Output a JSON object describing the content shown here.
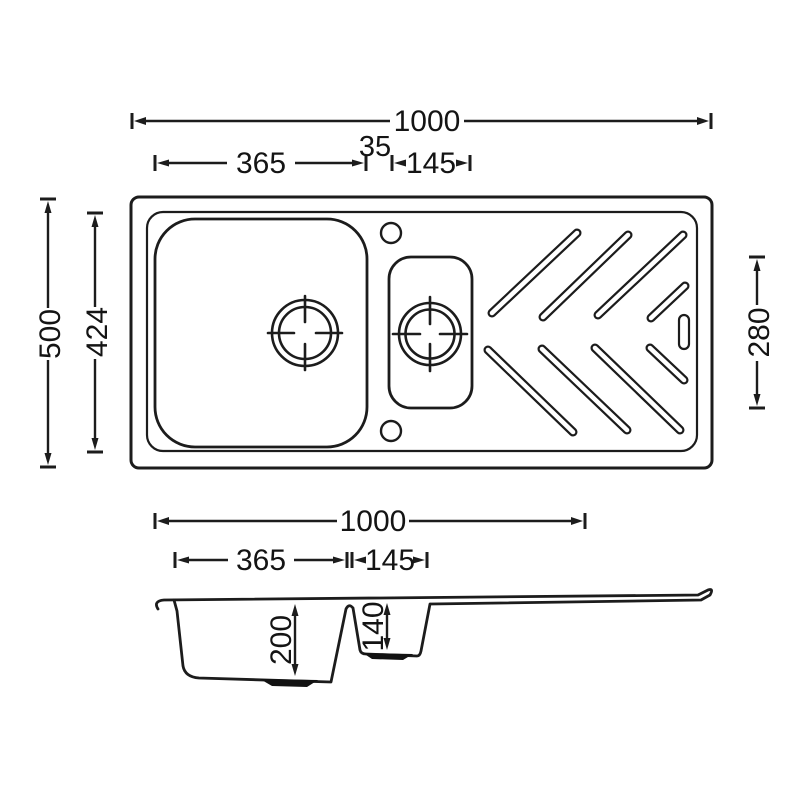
{
  "drawing_type": "kitchen-sink-dimension-diagram",
  "plan": {
    "overall_width_mm": "1000",
    "main_bowl_width_mm": "365",
    "between_bowls_mm": "35",
    "half_bowl_width_mm": "145",
    "overall_depth_mm": "500",
    "inner_frame_depth_mm": "424",
    "half_bowl_length_mm": "280"
  },
  "section": {
    "overall_width_mm": "1000",
    "main_bowl_width_mm": "365",
    "half_bowl_width_mm": "145",
    "main_bowl_depth_mm": "200",
    "half_bowl_depth_mm": "140"
  },
  "colors": {
    "line": "#1c1c1c",
    "background": "#ffffff"
  }
}
